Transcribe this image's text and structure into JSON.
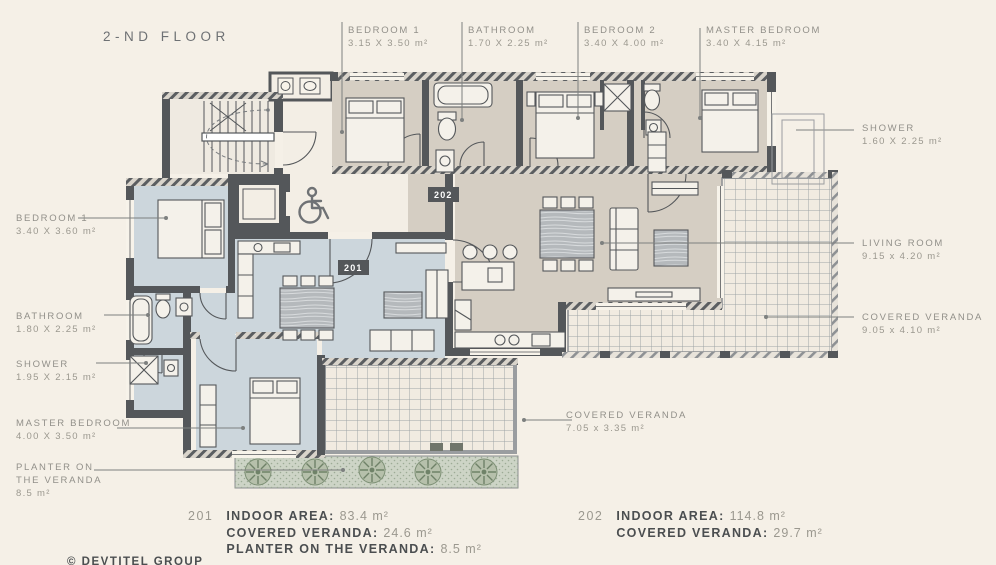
{
  "title": "2-ND FLOOR",
  "badges": {
    "unit201": "201",
    "unit202": "202"
  },
  "labels": [
    {
      "room": "BEDROOM 1",
      "dims": "3.15 X 3.50 m²"
    },
    {
      "room": "BATHROOM",
      "dims": "1.70 X 2.25 m²"
    },
    {
      "room": "BEDROOM 2",
      "dims": "3.40 X 4.00 m²"
    },
    {
      "room": "MASTER BEDROOM",
      "dims": "3.40 X 4.15 m²"
    },
    {
      "room": "SHOWER",
      "dims": "1.60 X 2.25 m²"
    },
    {
      "room": "LIVING ROOM",
      "dims": "9.15 x 4.20 m²"
    },
    {
      "room": "COVERED VERANDA",
      "dims": "9.05 x 4.10 m²"
    },
    {
      "room": "BEDROOM 1",
      "dims": "3.40 X 3.60 m²"
    },
    {
      "room": "BATHROOM",
      "dims": "1.80 X 2.25 m²"
    },
    {
      "room": "SHOWER",
      "dims": "1.95 X 2.15 m²"
    },
    {
      "room": "MASTER BEDROOM",
      "dims": "4.00 X 3.50 m²"
    },
    {
      "room": "PLANTER ON THE VERANDA",
      "dims": "8.5 m²"
    },
    {
      "room": "COVERED VERANDA",
      "dims": "7.05 x 3.35 m²"
    }
  ],
  "stats": {
    "unit201": {
      "number": "201",
      "lines": [
        {
          "label": "INDOOR AREA:",
          "value": "83.4 m²"
        },
        {
          "label": "COVERED VERANDA:",
          "value": "24.6 m²"
        },
        {
          "label": "PLANTER ON THE VERANDA:",
          "value": "8.5 m²"
        }
      ]
    },
    "unit202": {
      "number": "202",
      "lines": [
        {
          "label": "INDOOR AREA:",
          "value": "114.8 m²"
        },
        {
          "label": "COVERED VERANDA:",
          "value": "29.7 m²"
        }
      ]
    }
  },
  "footer": {
    "copyright": "© DEVTITEL GROUP"
  },
  "colors": {
    "background": "#f5f0e7",
    "wall": "#54575a",
    "unit201_fill": "#ccd6dc",
    "unit202_fill": "#d5cec3",
    "corridor_fill": "#f3eee5",
    "veranda_fill": "#f1ebe1",
    "planter_fill": "#cdd4c6",
    "label_text": "#92908a",
    "stats_text": "#4b4e50",
    "badge_bg": "#54575a"
  }
}
